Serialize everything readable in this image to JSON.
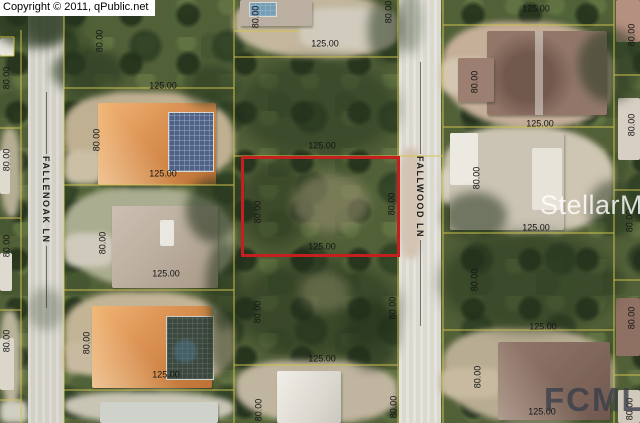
{
  "copyright_text": "Copyright © 2011, qPublic.net",
  "streets": [
    {
      "name": "FALLENOAK LN"
    },
    {
      "name": "FALLWOOD LN"
    }
  ],
  "watermarks": {
    "stellar_mls": "StellarMLS",
    "fcmls": "FCMLS"
  },
  "colors": {
    "parcel_line": "#d2c44e",
    "highlight_outline": "#c52020"
  },
  "highlighted_parcel": {
    "frontage_label": "125.00",
    "depth_label": "80.00"
  },
  "dimension_labels": [
    {
      "text": "125.00",
      "x": 163,
      "y": 86,
      "rot": 0
    },
    {
      "text": "125.00",
      "x": 163,
      "y": 174,
      "rot": 0
    },
    {
      "text": "125.00",
      "x": 166,
      "y": 274,
      "rot": 0
    },
    {
      "text": "125.00",
      "x": 166,
      "y": 375,
      "rot": 0
    },
    {
      "text": "125.00",
      "x": 325,
      "y": 44,
      "rot": 0
    },
    {
      "text": "125.00",
      "x": 322,
      "y": 146,
      "rot": 0
    },
    {
      "text": "125.00",
      "x": 322,
      "y": 247,
      "rot": 0
    },
    {
      "text": "125.00",
      "x": 322,
      "y": 359,
      "rot": 0
    },
    {
      "text": "125.00",
      "x": 536,
      "y": 9,
      "rot": 0
    },
    {
      "text": "125.00",
      "x": 540,
      "y": 124,
      "rot": 0
    },
    {
      "text": "125.00",
      "x": 536,
      "y": 228,
      "rot": 0
    },
    {
      "text": "125.00",
      "x": 543,
      "y": 327,
      "rot": 0
    },
    {
      "text": "125.00",
      "x": 542,
      "y": 412,
      "rot": 0
    },
    {
      "text": "80.00",
      "x": 7,
      "y": 78,
      "rot": -90
    },
    {
      "text": "80.00",
      "x": 7,
      "y": 160,
      "rot": -90
    },
    {
      "text": "80.00",
      "x": 7,
      "y": 246,
      "rot": -90
    },
    {
      "text": "80.00",
      "x": 7,
      "y": 341,
      "rot": -90
    },
    {
      "text": "80.00",
      "x": 100,
      "y": 41,
      "rot": -90
    },
    {
      "text": "80.00",
      "x": 97,
      "y": 140,
      "rot": -90
    },
    {
      "text": "80.00",
      "x": 103,
      "y": 243,
      "rot": -90
    },
    {
      "text": "80.00",
      "x": 87,
      "y": 343,
      "rot": -90
    },
    {
      "text": "80.00",
      "x": 256,
      "y": 17,
      "rot": -90
    },
    {
      "text": "80.00",
      "x": 258,
      "y": 212,
      "rot": -90
    },
    {
      "text": "80.00",
      "x": 258,
      "y": 312,
      "rot": -90
    },
    {
      "text": "80.00",
      "x": 259,
      "y": 410,
      "rot": -90
    },
    {
      "text": "80.00",
      "x": 389,
      "y": 12,
      "rot": -90
    },
    {
      "text": "80.00",
      "x": 392,
      "y": 204,
      "rot": -90
    },
    {
      "text": "80.00",
      "x": 393,
      "y": 308,
      "rot": -90
    },
    {
      "text": "80.00",
      "x": 394,
      "y": 407,
      "rot": -90
    },
    {
      "text": "80.00",
      "x": 475,
      "y": 82,
      "rot": -90
    },
    {
      "text": "80.00",
      "x": 477,
      "y": 178,
      "rot": -90
    },
    {
      "text": "80.00",
      "x": 475,
      "y": 280,
      "rot": -90
    },
    {
      "text": "80.00",
      "x": 478,
      "y": 377,
      "rot": -90
    },
    {
      "text": "80.00",
      "x": 632,
      "y": 35,
      "rot": -90
    },
    {
      "text": "80.00",
      "x": 632,
      "y": 125,
      "rot": -90
    },
    {
      "text": "80.00",
      "x": 630,
      "y": 221,
      "rot": -90
    },
    {
      "text": "80.00",
      "x": 632,
      "y": 318,
      "rot": -90
    },
    {
      "text": "80.00",
      "x": 630,
      "y": 409,
      "rot": -90
    }
  ]
}
